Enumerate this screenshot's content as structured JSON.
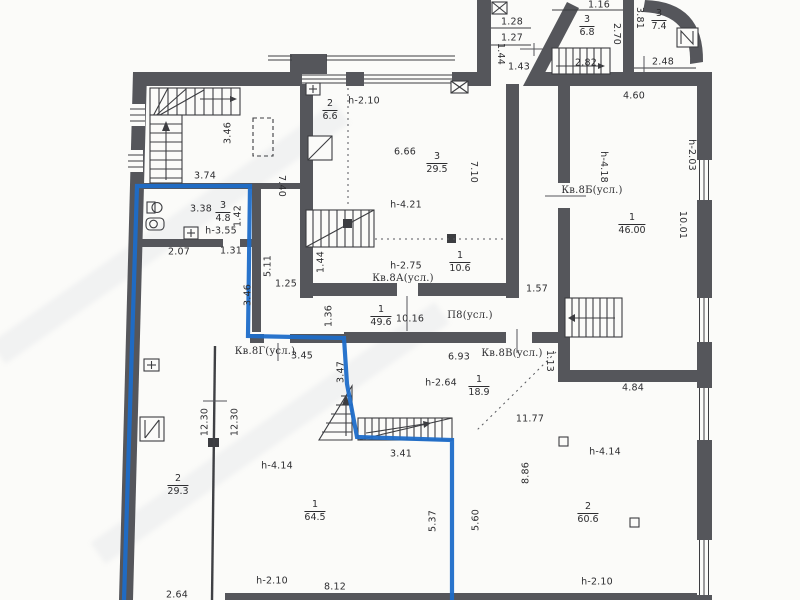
{
  "document": {
    "kind_label": "floor-plan-scan"
  },
  "colors": {
    "wall": "#55565b",
    "line": "#3c3d41",
    "highlight_blue": "#1d6dc9",
    "paper": "#fbfbf9",
    "text": "#2d2d30"
  },
  "apartments": {
    "a": "Кв.8А(усл.)",
    "b": "Кв.8Б(усл.)",
    "v": "Кв.8В(усл.)",
    "g": "Кв.8Г(усл.)",
    "p": "П8(усл.)"
  },
  "fractions": {
    "f68": {
      "num": "3",
      "den": "6.8"
    },
    "f74": {
      "num": "3",
      "den": "7.4"
    },
    "f48": {
      "num": "3",
      "den": "4.8"
    },
    "f66": {
      "num": "2",
      "den": "6.6"
    },
    "f295": {
      "num": "3",
      "den": "29.5"
    },
    "f106": {
      "num": "1",
      "den": "10.6"
    },
    "f496": {
      "num": "1",
      "den": "49.6"
    },
    "f189": {
      "num": "1",
      "den": "18.9"
    },
    "f4600": {
      "num": "1",
      "den": "46.00"
    },
    "f606": {
      "num": "2",
      "den": "60.6"
    },
    "f293": {
      "num": "2",
      "den": "29.3"
    },
    "f645": {
      "num": "1",
      "den": "64.5"
    }
  },
  "texts": {
    "d116": "1.16",
    "d128": "1.28",
    "d127": "1.27",
    "d144t": "1.44",
    "d143": "1.43",
    "d282": "2.82",
    "d270": "2.70",
    "d381": "3.81",
    "d248": "2.48",
    "d460": "4.60",
    "d346a": "3.46",
    "d374": "3.74",
    "d740": "7.40",
    "d338": "3.38",
    "d142": "1.42",
    "h355": "h-3.55",
    "d207": "2.07",
    "d131": "1.31",
    "d511": "5.11",
    "d125": "1.25",
    "d346b": "3.46",
    "d136": "1.36",
    "d144b": "1.44",
    "h210a": "h-2.10",
    "d666": "6.66",
    "d710": "7.10",
    "h421": "h-4.21",
    "h275": "h-2.75",
    "d1016": "10.16",
    "d157": "1.57",
    "d345": "3.45",
    "d347": "3.47",
    "d693": "6.93",
    "d113": "1.13",
    "h264": "h-2.64",
    "h418": "h-4.18",
    "h203": "h-2.03",
    "d1001": "10.01",
    "d484": "4.84",
    "d1177": "11.77",
    "d886": "8.86",
    "h414r": "h-4.14",
    "h210r": "h-2.10",
    "d1230a": "12.30",
    "d1230b": "12.30",
    "h414l": "h-4.14",
    "d341": "3.41",
    "d537": "5.37",
    "d560": "5.60",
    "h210b": "h-2.10",
    "d812": "8.12",
    "d264": "2.64"
  },
  "icons": {
    "stairs": "stair-flight-with-direction-arrow",
    "plus_box": "door-leaf-box",
    "x_box": "vent-shaft-cross-box",
    "diag_box": "hatch-duct-box",
    "n_box": "niche-box",
    "sink": "wash-basin",
    "toilet": "toilet-bowl",
    "blue_outline": "apartment-8g-boundary-highlight"
  }
}
